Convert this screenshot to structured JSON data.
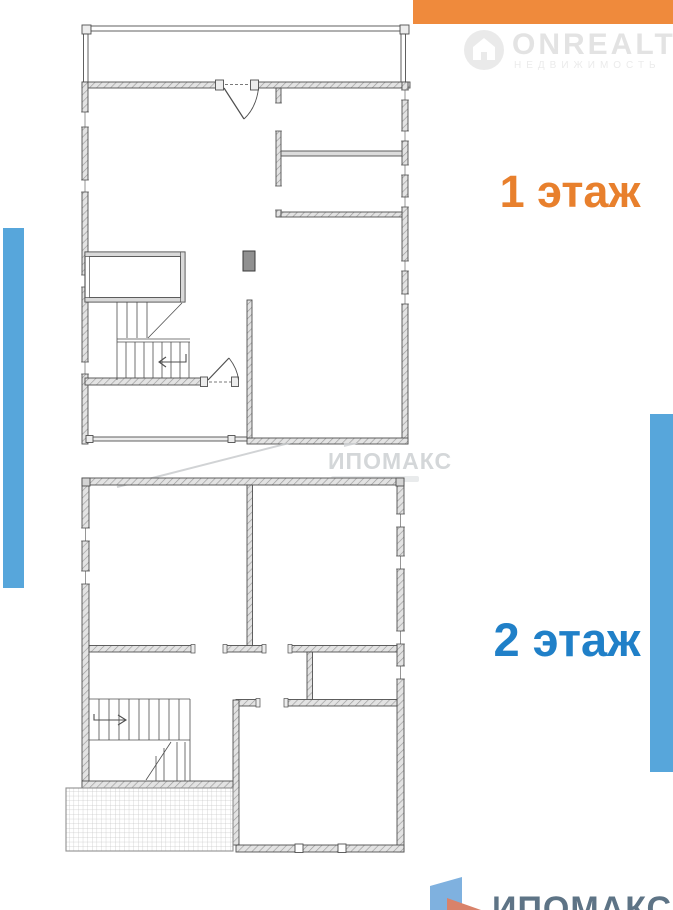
{
  "colors": {
    "orange_bar": "#EF8A3C",
    "floor1_label": "#E8802D",
    "floor2_label": "#2080C8",
    "side_bar": "#57A6DB",
    "watermark_gray": "#E3E3E3",
    "ipomax_watermark_gray": "#D4D7D9",
    "footer_text": "#5E7486",
    "flag_blue": "#7FB1DF",
    "flag_orange": "#D9826A",
    "plan_wall_fill": "#E3E3E3",
    "plan_line": "#4F4F4F"
  },
  "watermarks": {
    "top": {
      "brand": "ONREALT",
      "tagline": "НЕДВИЖИМОСТЬ"
    },
    "middle": {
      "brand": "ИПОМАКС"
    }
  },
  "floors": {
    "floor1": {
      "label": "1 этаж"
    },
    "floor2": {
      "label": "2 этаж"
    }
  },
  "footer": {
    "brand": "ИПОМАКС"
  }
}
